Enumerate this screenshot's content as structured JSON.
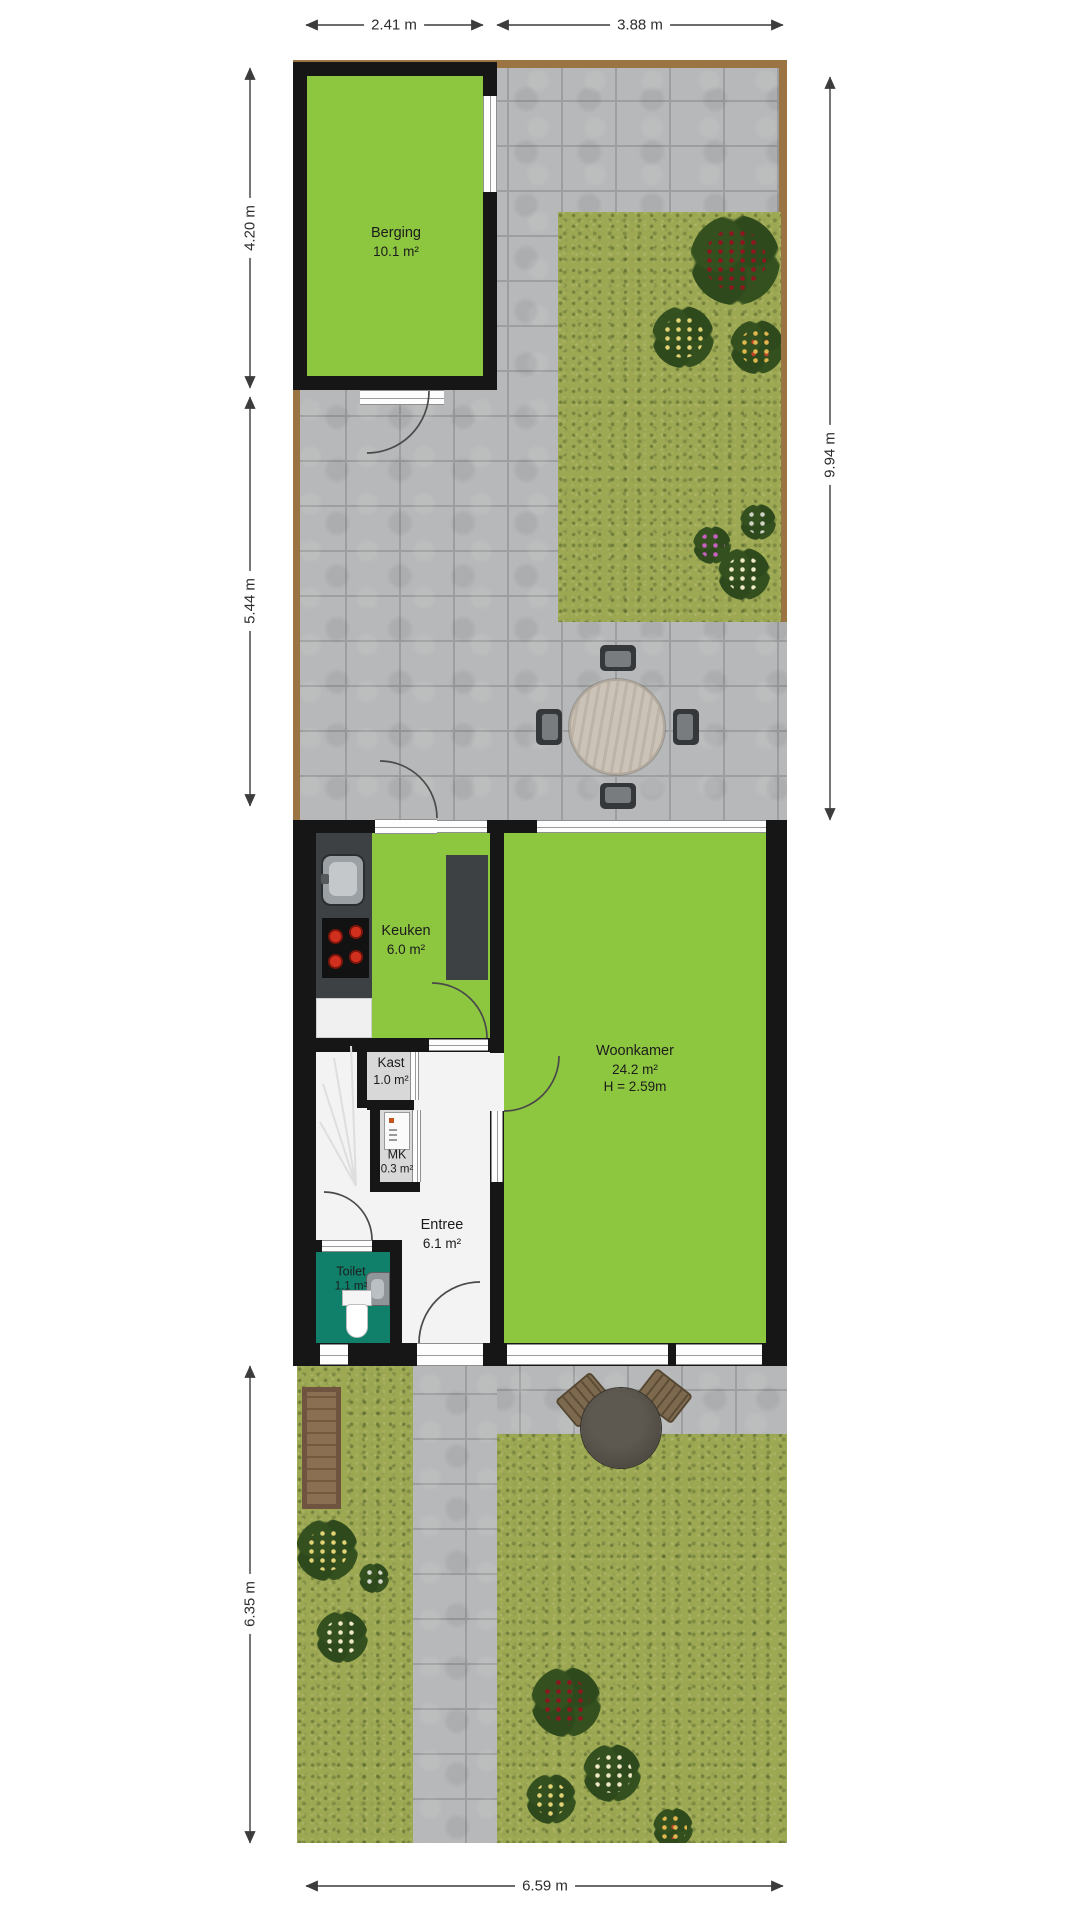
{
  "plan_type": "floorplan-with-garden",
  "rooms": {
    "berging": {
      "name": "Berging",
      "area": "10.1 m²"
    },
    "keuken": {
      "name": "Keuken",
      "area": "6.0 m²"
    },
    "kast": {
      "name": "Kast",
      "area": "1.0 m²"
    },
    "mk": {
      "name": "MK",
      "area": "0.3 m²"
    },
    "entree": {
      "name": "Entree",
      "area": "6.1 m²"
    },
    "toilet": {
      "name": "Toilet",
      "area": "1.1 m²"
    },
    "woonkamer": {
      "name": "Woonkamer",
      "area": "24.2 m²",
      "height": "H = 2.59m"
    }
  },
  "dimensions": {
    "top_left": "2.41 m",
    "top_right": "3.88 m",
    "left_upper": "4.20 m",
    "left_middle": "5.44 m",
    "left_lower": "6.35 m",
    "right_side": "9.94 m",
    "bottom": "6.59 m"
  },
  "colors": {
    "room_green": "#8dc63f",
    "wall_black": "#161616",
    "toilet_teal": "#11806b",
    "paving_grey": "#b6b8b9",
    "grass_green": "#9da853",
    "fence_brown": "#9b7443"
  }
}
